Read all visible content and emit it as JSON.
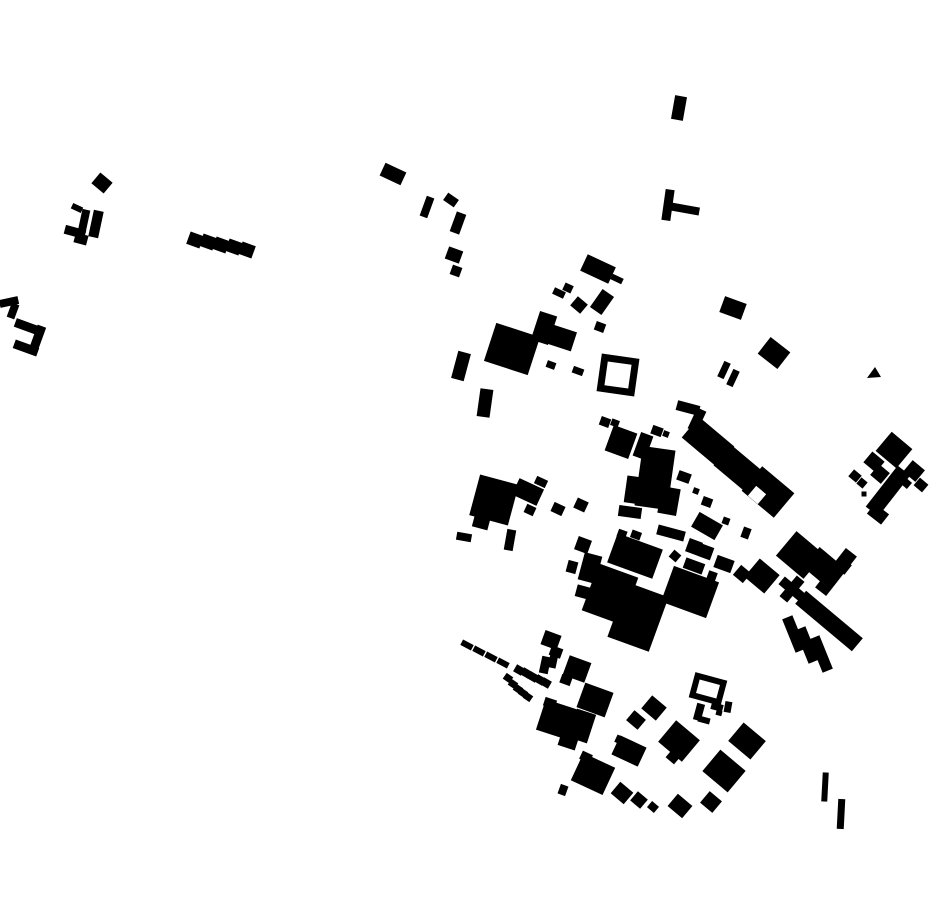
{
  "canvas": {
    "width": 930,
    "height": 924,
    "background": "#ffffff"
  },
  "colors": {
    "building": "#000000",
    "background": "#ffffff",
    "notch": "#ffffff"
  },
  "map": {
    "kind": "figure-ground building footprints",
    "shapes": [
      {
        "cx": 102,
        "cy": 183,
        "w": 16,
        "h": 14,
        "r": 40
      },
      {
        "cx": 77,
        "cy": 208,
        "w": 11,
        "h": 6,
        "r": 25
      },
      {
        "cx": 84,
        "cy": 221,
        "w": 8,
        "h": 23,
        "r": 12
      },
      {
        "cx": 96,
        "cy": 224,
        "w": 10,
        "h": 27,
        "r": 12
      },
      {
        "cx": 75,
        "cy": 232,
        "w": 21,
        "h": 9,
        "r": 15
      },
      {
        "cx": 81,
        "cy": 239,
        "w": 13,
        "h": 10,
        "r": 15
      },
      {
        "cx": 195,
        "cy": 240,
        "w": 14,
        "h": 13,
        "r": 20
      },
      {
        "cx": 208,
        "cy": 242,
        "w": 14,
        "h": 13,
        "r": 20
      },
      {
        "cx": 221,
        "cy": 245,
        "w": 14,
        "h": 13,
        "r": 20
      },
      {
        "cx": 234,
        "cy": 247,
        "w": 14,
        "h": 13,
        "r": 20
      },
      {
        "cx": 247,
        "cy": 250,
        "w": 14,
        "h": 13,
        "r": 20
      },
      {
        "cx": 9,
        "cy": 302,
        "w": 19,
        "h": 8,
        "r": -12
      },
      {
        "cx": 13,
        "cy": 311,
        "w": 8,
        "h": 15,
        "r": 20
      },
      {
        "cx": 28,
        "cy": 327,
        "w": 27,
        "h": 9,
        "r": 20
      },
      {
        "cx": 38,
        "cy": 337,
        "w": 9,
        "h": 23,
        "r": 20
      },
      {
        "cx": 26,
        "cy": 348,
        "w": 25,
        "h": 9,
        "r": 20
      },
      {
        "cx": 393,
        "cy": 174,
        "w": 23,
        "h": 14,
        "r": 25
      },
      {
        "cx": 427,
        "cy": 207,
        "w": 8,
        "h": 21,
        "r": 20
      },
      {
        "cx": 451,
        "cy": 200,
        "w": 13,
        "h": 9,
        "r": 35
      },
      {
        "cx": 458,
        "cy": 223,
        "w": 10,
        "h": 21,
        "r": 20
      },
      {
        "cx": 454,
        "cy": 255,
        "w": 15,
        "h": 13,
        "r": 20
      },
      {
        "cx": 456,
        "cy": 271,
        "w": 10,
        "h": 10,
        "r": 20
      },
      {
        "cx": 679,
        "cy": 108,
        "w": 12,
        "h": 24,
        "r": 10
      },
      {
        "cx": 668,
        "cy": 205,
        "w": 9,
        "h": 31,
        "r": 8
      },
      {
        "cx": 685,
        "cy": 209,
        "w": 29,
        "h": 8,
        "r": 10
      },
      {
        "cx": 598,
        "cy": 269,
        "w": 31,
        "h": 18,
        "r": 25
      },
      {
        "cx": 617,
        "cy": 279,
        "w": 12,
        "h": 6,
        "r": 25
      },
      {
        "cx": 559,
        "cy": 293,
        "w": 12,
        "h": 7,
        "r": 25
      },
      {
        "cx": 568,
        "cy": 288,
        "w": 9,
        "h": 8,
        "r": 25
      },
      {
        "cx": 579,
        "cy": 305,
        "w": 13,
        "h": 12,
        "r": 40
      },
      {
        "cx": 602,
        "cy": 302,
        "w": 14,
        "h": 22,
        "r": 35
      },
      {
        "cx": 600,
        "cy": 327,
        "w": 10,
        "h": 9,
        "r": 20
      },
      {
        "cx": 512,
        "cy": 349,
        "w": 46,
        "h": 40,
        "r": 18
      },
      {
        "cx": 544,
        "cy": 328,
        "w": 18,
        "h": 30,
        "r": 18
      },
      {
        "cx": 562,
        "cy": 338,
        "w": 25,
        "h": 20,
        "r": 18
      },
      {
        "cx": 551,
        "cy": 365,
        "w": 9,
        "h": 7,
        "r": 20
      },
      {
        "cx": 578,
        "cy": 371,
        "w": 11,
        "h": 7,
        "r": 20
      },
      {
        "cx": 618,
        "cy": 375,
        "w": 31,
        "h": 31,
        "r": 8,
        "type": "outline",
        "sw": 7
      },
      {
        "cx": 461,
        "cy": 366,
        "w": 13,
        "h": 28,
        "r": 15
      },
      {
        "cx": 485,
        "cy": 403,
        "w": 13,
        "h": 28,
        "r": 8
      },
      {
        "cx": 733,
        "cy": 308,
        "w": 23,
        "h": 17,
        "r": 20
      },
      {
        "cx": 774,
        "cy": 353,
        "w": 25,
        "h": 21,
        "r": 38
      },
      {
        "cx": 724,
        "cy": 370,
        "w": 7,
        "h": 17,
        "r": 25
      },
      {
        "cx": 733,
        "cy": 378,
        "w": 7,
        "h": 17,
        "r": 25
      },
      {
        "type": "poly",
        "pts": "867,378 875,367 881,377"
      },
      {
        "cx": 605,
        "cy": 422,
        "w": 10,
        "h": 9,
        "r": 20
      },
      {
        "cx": 615,
        "cy": 423,
        "w": 8,
        "h": 7,
        "r": 20
      },
      {
        "cx": 621,
        "cy": 442,
        "w": 25,
        "h": 27,
        "r": 20
      },
      {
        "cx": 643,
        "cy": 446,
        "w": 13,
        "h": 25,
        "r": 20
      },
      {
        "cx": 657,
        "cy": 431,
        "w": 11,
        "h": 9,
        "r": 20
      },
      {
        "cx": 666,
        "cy": 434,
        "w": 6,
        "h": 6,
        "r": 20
      },
      {
        "cx": 655,
        "cy": 478,
        "w": 33,
        "h": 60,
        "r": 8
      },
      {
        "cx": 634,
        "cy": 490,
        "w": 17,
        "h": 27,
        "r": 8
      },
      {
        "cx": 630,
        "cy": 512,
        "w": 23,
        "h": 11,
        "r": 8
      },
      {
        "cx": 688,
        "cy": 408,
        "w": 23,
        "h": 10,
        "r": 15
      },
      {
        "cx": 697,
        "cy": 420,
        "w": 10,
        "h": 23,
        "r": 25
      },
      {
        "cx": 708,
        "cy": 442,
        "w": 46,
        "h": 27,
        "r": 40
      },
      {
        "cx": 739,
        "cy": 469,
        "w": 44,
        "h": 27,
        "r": 40
      },
      {
        "cx": 768,
        "cy": 492,
        "w": 42,
        "h": 32,
        "r": 40
      },
      {
        "cx": 757,
        "cy": 495,
        "w": 13,
        "h": 13,
        "r": 40,
        "fill": "#ffffff"
      },
      {
        "cx": 684,
        "cy": 477,
        "w": 13,
        "h": 10,
        "r": 20
      },
      {
        "cx": 696,
        "cy": 491,
        "w": 6,
        "h": 6,
        "r": 20
      },
      {
        "cx": 707,
        "cy": 502,
        "w": 10,
        "h": 9,
        "r": 20
      },
      {
        "cx": 669,
        "cy": 501,
        "w": 19,
        "h": 27,
        "r": 10
      },
      {
        "cx": 707,
        "cy": 526,
        "w": 27,
        "h": 17,
        "r": 30
      },
      {
        "cx": 726,
        "cy": 521,
        "w": 7,
        "h": 7,
        "r": 20
      },
      {
        "cx": 746,
        "cy": 533,
        "w": 8,
        "h": 11,
        "r": 20
      },
      {
        "cx": 494,
        "cy": 500,
        "w": 40,
        "h": 42,
        "r": 15
      },
      {
        "cx": 481,
        "cy": 523,
        "w": 16,
        "h": 11,
        "r": 15
      },
      {
        "cx": 528,
        "cy": 492,
        "w": 27,
        "h": 18,
        "r": 25
      },
      {
        "cx": 541,
        "cy": 482,
        "w": 12,
        "h": 8,
        "r": 25
      },
      {
        "cx": 530,
        "cy": 510,
        "w": 10,
        "h": 9,
        "r": 25
      },
      {
        "cx": 558,
        "cy": 509,
        "w": 12,
        "h": 10,
        "r": 25
      },
      {
        "cx": 581,
        "cy": 505,
        "w": 12,
        "h": 11,
        "r": 25
      },
      {
        "cx": 464,
        "cy": 537,
        "w": 15,
        "h": 8,
        "r": 10
      },
      {
        "cx": 510,
        "cy": 540,
        "w": 9,
        "h": 21,
        "r": 10
      },
      {
        "cx": 583,
        "cy": 545,
        "w": 14,
        "h": 14,
        "r": 20
      },
      {
        "cx": 590,
        "cy": 568,
        "w": 18,
        "h": 28,
        "r": 15
      },
      {
        "cx": 572,
        "cy": 567,
        "w": 10,
        "h": 12,
        "r": 15
      },
      {
        "cx": 583,
        "cy": 592,
        "w": 14,
        "h": 12,
        "r": 15
      },
      {
        "cx": 635,
        "cy": 556,
        "w": 48,
        "h": 31,
        "r": 20
      },
      {
        "cx": 610,
        "cy": 594,
        "w": 42,
        "h": 50,
        "r": 20
      },
      {
        "cx": 638,
        "cy": 617,
        "w": 44,
        "h": 58,
        "r": 20
      },
      {
        "cx": 690,
        "cy": 592,
        "w": 48,
        "h": 38,
        "r": 20
      },
      {
        "cx": 622,
        "cy": 534,
        "w": 9,
        "h": 8,
        "r": 20
      },
      {
        "cx": 636,
        "cy": 535,
        "w": 10,
        "h": 8,
        "r": 20
      },
      {
        "cx": 671,
        "cy": 533,
        "w": 28,
        "h": 10,
        "r": 15
      },
      {
        "cx": 694,
        "cy": 547,
        "w": 14,
        "h": 14,
        "r": 20
      },
      {
        "cx": 706,
        "cy": 552,
        "w": 13,
        "h": 13,
        "r": 20
      },
      {
        "cx": 675,
        "cy": 556,
        "w": 9,
        "h": 9,
        "r": 40
      },
      {
        "cx": 694,
        "cy": 566,
        "w": 20,
        "h": 11,
        "r": 20
      },
      {
        "cx": 724,
        "cy": 564,
        "w": 18,
        "h": 13,
        "r": 20
      },
      {
        "cx": 712,
        "cy": 576,
        "w": 9,
        "h": 9,
        "r": 20
      },
      {
        "cx": 742,
        "cy": 574,
        "w": 13,
        "h": 13,
        "r": 40
      },
      {
        "cx": 762,
        "cy": 576,
        "w": 26,
        "h": 24,
        "r": 40
      },
      {
        "cx": 800,
        "cy": 555,
        "w": 36,
        "h": 32,
        "r": 40
      },
      {
        "cx": 822,
        "cy": 566,
        "w": 28,
        "h": 26,
        "r": 40
      },
      {
        "cx": 792,
        "cy": 589,
        "w": 27,
        "h": 10,
        "r": 40
      },
      {
        "cx": 792,
        "cy": 589,
        "w": 10,
        "h": 27,
        "r": 40
      },
      {
        "cx": 836,
        "cy": 572,
        "w": 14,
        "h": 50,
        "r": 38
      },
      {
        "cx": 843,
        "cy": 566,
        "w": 13,
        "h": 12,
        "r": 38
      },
      {
        "cx": 829,
        "cy": 621,
        "w": 74,
        "h": 17,
        "r": 40
      },
      {
        "cx": 794,
        "cy": 634,
        "w": 11,
        "h": 36,
        "r": -22
      },
      {
        "cx": 807,
        "cy": 645,
        "w": 11,
        "h": 36,
        "r": -22
      },
      {
        "cx": 821,
        "cy": 654,
        "w": 11,
        "h": 36,
        "r": -22
      },
      {
        "cx": 467,
        "cy": 645,
        "w": 12,
        "h": 6,
        "r": 28
      },
      {
        "cx": 479,
        "cy": 651,
        "w": 12,
        "h": 6,
        "r": 28
      },
      {
        "cx": 491,
        "cy": 657,
        "w": 12,
        "h": 6,
        "r": 28
      },
      {
        "cx": 503,
        "cy": 663,
        "w": 12,
        "h": 6,
        "r": 28
      },
      {
        "cx": 519,
        "cy": 670,
        "w": 9,
        "h": 8,
        "r": 30
      },
      {
        "cx": 526,
        "cy": 673,
        "w": 9,
        "h": 8,
        "r": 30
      },
      {
        "cx": 533,
        "cy": 677,
        "w": 9,
        "h": 8,
        "r": 30
      },
      {
        "cx": 540,
        "cy": 680,
        "w": 9,
        "h": 8,
        "r": 30
      },
      {
        "cx": 546,
        "cy": 683,
        "w": 9,
        "h": 8,
        "r": 30
      },
      {
        "cx": 508,
        "cy": 678,
        "w": 8,
        "h": 7,
        "r": 35
      },
      {
        "cx": 513,
        "cy": 684,
        "w": 8,
        "h": 7,
        "r": 35
      },
      {
        "cx": 518,
        "cy": 689,
        "w": 8,
        "h": 7,
        "r": 35
      },
      {
        "cx": 523,
        "cy": 693,
        "w": 8,
        "h": 7,
        "r": 35
      },
      {
        "cx": 528,
        "cy": 697,
        "w": 8,
        "h": 7,
        "r": 35
      },
      {
        "cx": 551,
        "cy": 640,
        "w": 17,
        "h": 15,
        "r": 20
      },
      {
        "cx": 556,
        "cy": 652,
        "w": 12,
        "h": 10,
        "r": 20
      },
      {
        "cx": 545,
        "cy": 665,
        "w": 9,
        "h": 17,
        "r": 12
      },
      {
        "cx": 553,
        "cy": 661,
        "w": 8,
        "h": 14,
        "r": 12
      },
      {
        "cx": 577,
        "cy": 669,
        "w": 23,
        "h": 21,
        "r": 20
      },
      {
        "cx": 566,
        "cy": 680,
        "w": 11,
        "h": 9,
        "r": 20
      },
      {
        "cx": 558,
        "cy": 720,
        "w": 36,
        "h": 32,
        "r": 18
      },
      {
        "cx": 582,
        "cy": 726,
        "w": 20,
        "h": 30,
        "r": 18
      },
      {
        "cx": 550,
        "cy": 703,
        "w": 12,
        "h": 9,
        "r": 18
      },
      {
        "cx": 568,
        "cy": 742,
        "w": 18,
        "h": 12,
        "r": 18
      },
      {
        "cx": 595,
        "cy": 700,
        "w": 30,
        "h": 26,
        "r": 20
      },
      {
        "cx": 708,
        "cy": 689,
        "w": 27,
        "h": 20,
        "r": 15,
        "type": "outline",
        "sw": 6
      },
      {
        "cx": 699,
        "cy": 712,
        "w": 8,
        "h": 17,
        "r": 15
      },
      {
        "cx": 704,
        "cy": 720,
        "w": 12,
        "h": 6,
        "r": 15
      },
      {
        "cx": 717,
        "cy": 707,
        "w": 12,
        "h": 7,
        "r": 15
      },
      {
        "cx": 719,
        "cy": 713,
        "w": 6,
        "h": 5,
        "r": 15
      },
      {
        "cx": 728,
        "cy": 707,
        "w": 7,
        "h": 11,
        "r": 10
      },
      {
        "cx": 654,
        "cy": 708,
        "w": 19,
        "h": 17,
        "r": 40
      },
      {
        "cx": 636,
        "cy": 720,
        "w": 15,
        "h": 13,
        "r": 40
      },
      {
        "cx": 629,
        "cy": 751,
        "w": 29,
        "h": 21,
        "r": 25
      },
      {
        "cx": 620,
        "cy": 740,
        "w": 9,
        "h": 8,
        "r": 25
      },
      {
        "cx": 679,
        "cy": 741,
        "w": 31,
        "h": 28,
        "r": 40
      },
      {
        "cx": 673,
        "cy": 757,
        "w": 11,
        "h": 10,
        "r": 40
      },
      {
        "cx": 724,
        "cy": 771,
        "w": 33,
        "h": 28,
        "r": 40
      },
      {
        "cx": 747,
        "cy": 741,
        "w": 29,
        "h": 24,
        "r": 40
      },
      {
        "cx": 593,
        "cy": 774,
        "w": 35,
        "h": 30,
        "r": 25
      },
      {
        "cx": 586,
        "cy": 757,
        "w": 11,
        "h": 9,
        "r": 25
      },
      {
        "cx": 622,
        "cy": 793,
        "w": 17,
        "h": 15,
        "r": 40
      },
      {
        "cx": 639,
        "cy": 800,
        "w": 13,
        "h": 12,
        "r": 40
      },
      {
        "cx": 653,
        "cy": 807,
        "w": 9,
        "h": 8,
        "r": 40
      },
      {
        "cx": 680,
        "cy": 806,
        "w": 19,
        "h": 16,
        "r": 40
      },
      {
        "cx": 711,
        "cy": 802,
        "w": 16,
        "h": 15,
        "r": 40
      },
      {
        "cx": 563,
        "cy": 790,
        "w": 8,
        "h": 10,
        "r": 20
      },
      {
        "cx": 825,
        "cy": 787,
        "w": 6,
        "h": 29,
        "r": 3
      },
      {
        "cx": 841,
        "cy": 814,
        "w": 7,
        "h": 30,
        "r": 3
      },
      {
        "cx": 894,
        "cy": 450,
        "w": 27,
        "h": 25,
        "r": 40
      },
      {
        "cx": 874,
        "cy": 462,
        "w": 16,
        "h": 14,
        "r": 40
      },
      {
        "cx": 880,
        "cy": 474,
        "w": 14,
        "h": 14,
        "r": 40
      },
      {
        "cx": 888,
        "cy": 491,
        "w": 16,
        "h": 52,
        "r": 38
      },
      {
        "cx": 878,
        "cy": 514,
        "w": 18,
        "h": 13,
        "r": 38
      },
      {
        "cx": 914,
        "cy": 471,
        "w": 16,
        "h": 15,
        "r": 40
      },
      {
        "cx": 921,
        "cy": 485,
        "w": 11,
        "h": 10,
        "r": 40
      },
      {
        "cx": 906,
        "cy": 483,
        "w": 9,
        "h": 8,
        "r": 40
      },
      {
        "cx": 855,
        "cy": 476,
        "w": 10,
        "h": 9,
        "r": 40
      },
      {
        "cx": 862,
        "cy": 483,
        "w": 8,
        "h": 8,
        "r": 40
      },
      {
        "cx": 864,
        "cy": 494,
        "w": 5,
        "h": 5,
        "r": 0
      }
    ]
  }
}
